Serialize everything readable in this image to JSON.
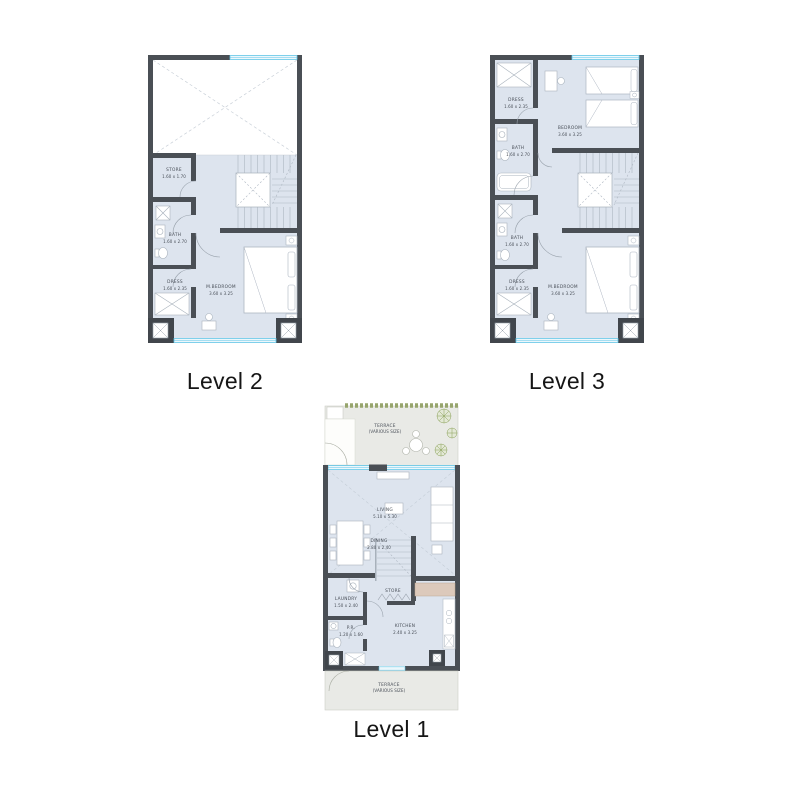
{
  "sheet": {
    "background": "#ffffff"
  },
  "colors": {
    "wall": "#4a4f55",
    "column": "#41464c",
    "floor": "#dde4ee",
    "window": "#5fc4e6",
    "terrace": "#e9eae6",
    "void_dash": "#c9d0d8",
    "fixture_stroke": "#aab3bd",
    "kitchen_counter": "#dcc9bb",
    "hedge_green": "#97a56d",
    "label_text": "#474d56",
    "level_label_text": "#161616"
  },
  "plans": [
    {
      "id": "level2",
      "label": "Level 2",
      "rooms": [
        {
          "name": "STORE",
          "dims": "1.60 x 1.70"
        },
        {
          "name": "BATH",
          "dims": "1.60 x 2.70"
        },
        {
          "name": "DRESS",
          "dims": "1.60 x 2.35"
        },
        {
          "name": "M.BEDROOM",
          "dims": "3.60 x 3.25"
        }
      ]
    },
    {
      "id": "level3",
      "label": "Level 3",
      "rooms": [
        {
          "name": "DRESS",
          "dims": "1.60 x 2.35"
        },
        {
          "name": "BEDROOM",
          "dims": "3.60 x 3.25"
        },
        {
          "name": "BATH",
          "dims": "1.60 x 2.70"
        },
        {
          "name": "BATH",
          "dims": "1.60 x 2.70"
        },
        {
          "name": "DRESS",
          "dims": "1.60 x 2.35"
        },
        {
          "name": "M.BEDROOM",
          "dims": "3.60 x 3.25"
        }
      ]
    },
    {
      "id": "level1",
      "label": "Level 1",
      "rooms": [
        {
          "name": "TERRACE",
          "dims": "(VARIOUS SIZE)"
        },
        {
          "name": "LIVING",
          "dims": "5.10 x 5.30"
        },
        {
          "name": "DINING",
          "dims": "2.80 x 2.40"
        },
        {
          "name": "LAUNDRY",
          "dims": "1.50 x 2.40"
        },
        {
          "name": "STORE",
          "dims": ""
        },
        {
          "name": "P.R.",
          "dims": "1.20 x 1.60"
        },
        {
          "name": "KITCHEN",
          "dims": "2.40 x 3.25"
        },
        {
          "name": "TERRACE",
          "dims": "(VARIOUS SIZE)"
        }
      ]
    }
  ]
}
